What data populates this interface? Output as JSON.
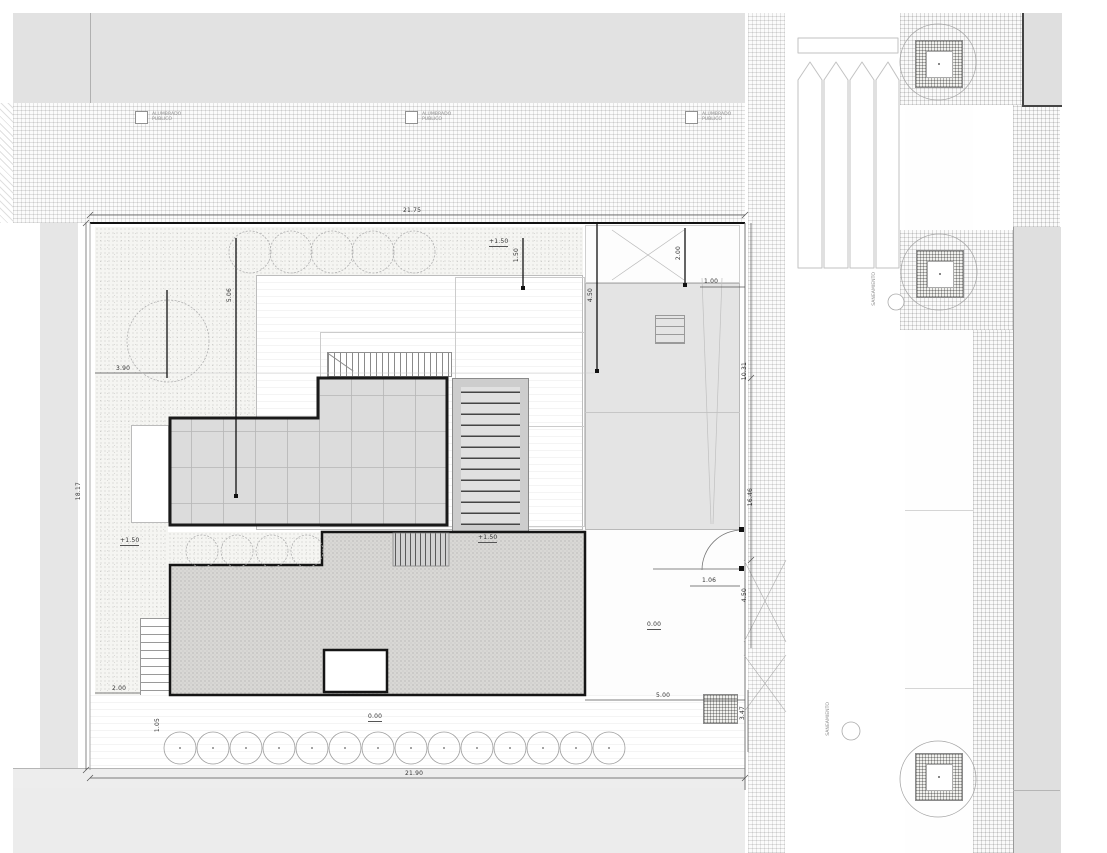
{
  "title": "Architectural site plan – roof level",
  "colors": {
    "paper": "#ffffff",
    "road": "#e2e2e2",
    "neighbor_block": "#dfdfdf",
    "skylight": "#dcdcdc",
    "ink": "#1a1a1a",
    "terrace": "#d9d8d5",
    "side_yard": "#e4e4e4"
  },
  "labels": {
    "lighting": "ALUMBRADO\nPUBLICO",
    "sewer": "SANEAMIENTO"
  },
  "levels": {
    "upper": "+1.50",
    "ground": "0.00"
  },
  "dimensions": {
    "site_top": "21.75",
    "site_bottom": "21.90",
    "site_left": "18.17",
    "right_upper": "10.31",
    "right_middle": "16.46",
    "right_gate": "4.50",
    "right_lower": "3.47",
    "gate_leaf": "1.06",
    "corner_offset": "1.00",
    "court_width": "5.00",
    "garden_step": "2.00",
    "planter_step": "1.05",
    "tree_offset": "3.90",
    "setback_a": "5.06",
    "setback_b": "1.50",
    "yard_depth": "4.50",
    "ramp_width": "2.00"
  }
}
